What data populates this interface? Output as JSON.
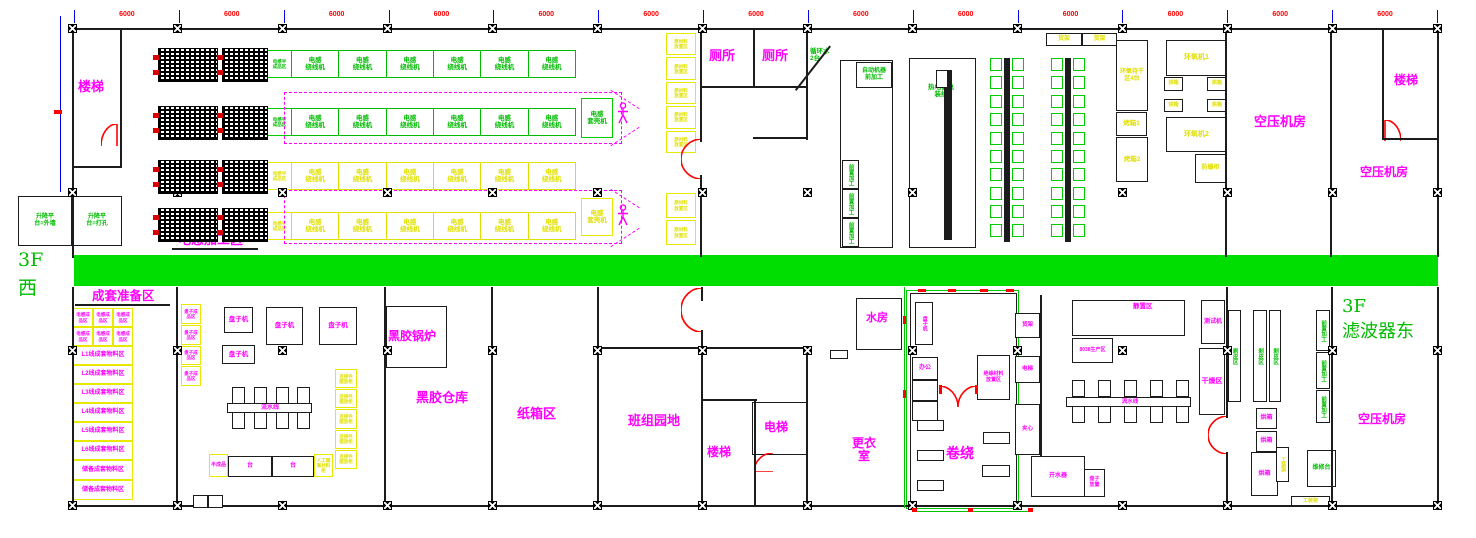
{
  "floor": {
    "left_top": "3F",
    "left_bottom": "西",
    "right_top": "3F",
    "right_bottom": "滤波器东"
  },
  "dims": {
    "bay": "6000"
  },
  "top": {
    "stairs": "楼梯",
    "lift_wall": "升降平\n台=外墙",
    "lift_drill": "升降平\n台=打孔",
    "semi": "电感半\n成品区",
    "winding": "电感\n绕线机",
    "casing": "电感\n套壳机",
    "zone": "电感加工区",
    "toilet": "厕所",
    "raw": "原材料\n放置区",
    "cooling": "循环水\n2台",
    "auto": "自动机器\n前加工",
    "pre": "前置加工",
    "thermo": "热电偶总\n装线",
    "shelf": "货架",
    "epoxy_dry": "环氧待干区4台",
    "oven1": "烤箱1",
    "oven2": "烤箱2",
    "oven_s": "烘箱",
    "epoxy1": "环氧机1",
    "epoxy2": "环氧机2",
    "explosion": "防爆柜",
    "air1": "空压机房",
    "air2": "空压机房",
    "stairs_tr": "楼梯"
  },
  "bottom": {
    "kitting": "成套准备区",
    "ind_done": "电感成\n品区",
    "mat_rows": [
      "L1线成套物料区",
      "L2线成套物料区",
      "L3线成套物料区",
      "L4线成套物料区",
      "L5线成套物料区",
      "L6线成套物料区",
      "储备成套物料区",
      "储备成套物料区"
    ],
    "plate_done": "盘子成\n品区",
    "plate_m": "盘子机",
    "line": "流水线",
    "semi": "半成品",
    "bench": "台",
    "manual": "人工隔\n离材料\n柜",
    "conn": "连接件\n摆放柜",
    "boiler": "黑胶锅炉",
    "store": "黑胶仓库",
    "carton": "纸箱区",
    "team": "班组园地",
    "stairs": "楼梯",
    "lift": "电梯",
    "water": "水房",
    "changing": "更衣\n室",
    "wind": "卷绕",
    "office": "办公",
    "plate_v": "盘子机",
    "insul": "绝缘材料\n放置区",
    "shelf2": "货架",
    "lift2": "电梯",
    "core": "夹心",
    "heater": "开水器",
    "plate_place": "盘子\n放置",
    "rest": "静置区",
    "prod": "8038生产区",
    "test": "测试机",
    "dry": "干燥区",
    "oven": "烘箱",
    "peel": "剥皮区",
    "pre2": "前置加工",
    "fixture": "工装架",
    "repair": "维修台",
    "air": "空压机房"
  }
}
